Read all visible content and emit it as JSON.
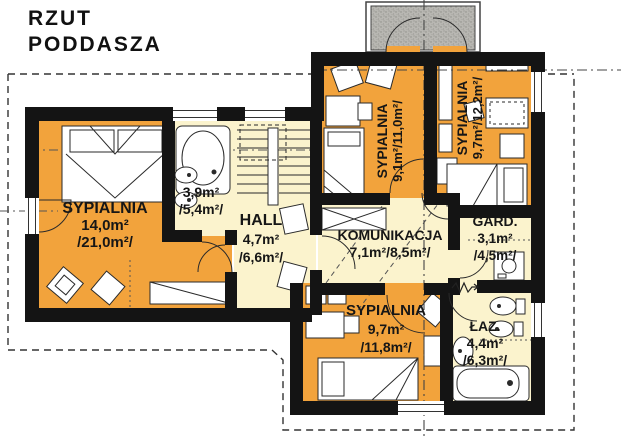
{
  "title": "RZUT\nPODDASZA",
  "colors": {
    "room_orange": "#F2A33C",
    "room_yellow": "#FBF3CD",
    "wall_black": "#141414",
    "terrace_gray": "#B5B4AF",
    "line_dark": "#333333"
  },
  "rooms": {
    "bedroom_left": {
      "name": "SYPIALNIA",
      "area": "14,0m²",
      "floor_area": "/21,0m²/"
    },
    "bathroom_small": {
      "area": "3,9m²",
      "floor_area": "/5,4m²/"
    },
    "hall": {
      "name": "HALL",
      "area": "4,7m²",
      "floor_area": "/6,6m²/"
    },
    "bedroom_top_middle": {
      "name": "SYPIALNIA",
      "area": "9,1m²/11,0m²/"
    },
    "bedroom_top_right": {
      "name": "SYPIALNIA",
      "area": "9,7m²/12,2m²/"
    },
    "komunikacja": {
      "name": "KOMUNIKACJA",
      "area": "7,1m²/8,5m²/"
    },
    "garderoba": {
      "name": "GARD.",
      "area": "3,1m²",
      "floor_area": "/4,5m²/"
    },
    "bedroom_bottom": {
      "name": "SYPIALNIA",
      "area": "9,7m²",
      "floor_area": "/11,8m²/"
    },
    "lazienka": {
      "name": "ŁAZ.",
      "area": "4,4m²",
      "floor_area": "/6,3m²/"
    }
  }
}
